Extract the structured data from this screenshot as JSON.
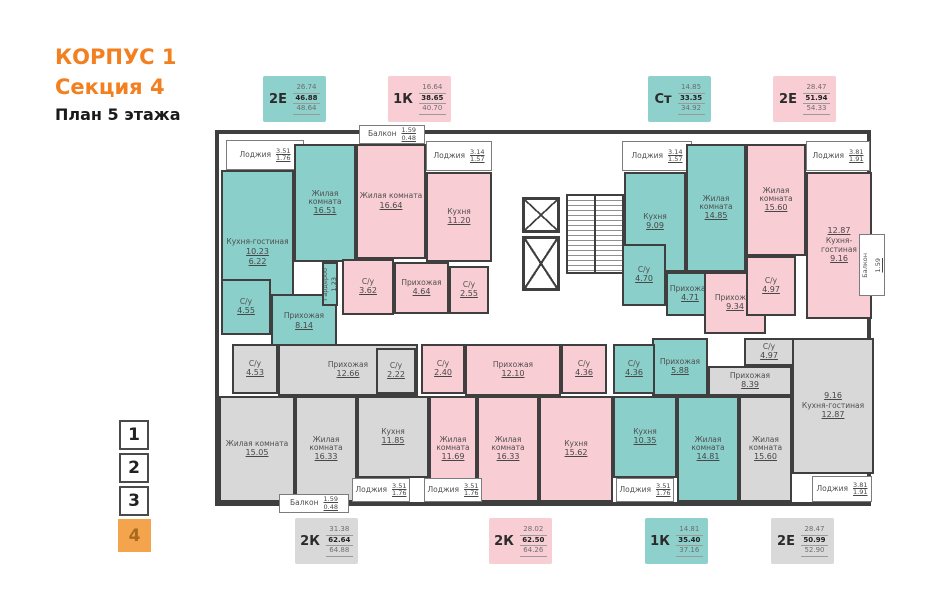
{
  "title": {
    "building": "КОРПУС 1",
    "section": "Секция 4",
    "plan": "План 5 этажа"
  },
  "colors": {
    "teal": "#8ed0cb",
    "pink": "#f9cdd4",
    "gray": "#d9d9d9",
    "wall": "#3f3f3f",
    "accent": "#f28021",
    "floor_active": "#f3a44c"
  },
  "legend_top": [
    {
      "type": "2Е",
      "color": "teal",
      "values": [
        "26.74",
        "46.88",
        "48.64"
      ]
    },
    {
      "type": "1К",
      "color": "pink",
      "values": [
        "16.64",
        "38.65",
        "40.70"
      ]
    },
    {
      "type": "Ст",
      "color": "teal",
      "values": [
        "14.85",
        "33.35",
        "34.92"
      ]
    },
    {
      "type": "2Е",
      "color": "pink",
      "values": [
        "28.47",
        "51.94",
        "54.33"
      ]
    }
  ],
  "legend_bottom": [
    {
      "type": "2К",
      "color": "gray",
      "values": [
        "31.38",
        "62.64",
        "64.88"
      ]
    },
    {
      "type": "2К",
      "color": "pink",
      "values": [
        "28.02",
        "62.50",
        "64.26"
      ]
    },
    {
      "type": "1К",
      "color": "teal",
      "values": [
        "14.81",
        "35.40",
        "37.16"
      ]
    },
    {
      "type": "2Е",
      "color": "gray",
      "values": [
        "28.47",
        "50.99",
        "52.90"
      ]
    }
  ],
  "floors": {
    "items": [
      "1",
      "2",
      "3",
      "4"
    ],
    "active": "4"
  },
  "rooms": [
    {
      "name": "Лоджия",
      "a": "3.51",
      "b": "1.76"
    },
    {
      "name": "Кухня-гостиная",
      "a": "10.23",
      "b": "6.22"
    },
    {
      "name": "Жилая комната",
      "a": "16.51"
    },
    {
      "name": "Гардероб",
      "a": "1.23"
    },
    {
      "name": "С/у",
      "a": "4.55"
    },
    {
      "name": "Прихожая",
      "a": "8.14"
    },
    {
      "name": "Балкон",
      "a": "1.59",
      "b": "0.48"
    },
    {
      "name": "Жилая комната",
      "a": "16.64"
    },
    {
      "name": "Лоджия",
      "a": "3.14",
      "b": "1.57"
    },
    {
      "name": "Кухня",
      "a": "11.20"
    },
    {
      "name": "С/у",
      "a": "3.62"
    },
    {
      "name": "Прихожая",
      "a": "4.64"
    },
    {
      "name": "С/у",
      "a": "2.55"
    },
    {
      "name": "Лоджия",
      "a": "3.14",
      "b": "1.57"
    },
    {
      "name": "Кухня",
      "a": "9.09"
    },
    {
      "name": "Жилая комната",
      "a": "14.85"
    },
    {
      "name": "С/у",
      "a": "4.70"
    },
    {
      "name": "Прихожая",
      "a": "4.71"
    },
    {
      "name": "Жилая комната",
      "a": "15.60"
    },
    {
      "name": "Лоджия",
      "a": "3.81",
      "b": "1.91"
    },
    {
      "name": "Кухня-гостиная",
      "a": "12.87",
      "b": "9.16"
    },
    {
      "name": "Прихожая",
      "a": "9.34"
    },
    {
      "name": "С/у",
      "a": "4.97"
    },
    {
      "name": "Балкон",
      "a": "1.59",
      "b": "0.48"
    },
    {
      "name": "С/у",
      "a": "4.53"
    },
    {
      "name": "Прихожая",
      "a": "12.66"
    },
    {
      "name": "С/у",
      "a": "2.22"
    },
    {
      "name": "Жилая комната",
      "a": "15.05"
    },
    {
      "name": "Жилая комната",
      "a": "16.33"
    },
    {
      "name": "Кухня",
      "a": "11.85"
    },
    {
      "name": "Лоджия",
      "a": "3.51",
      "b": "1.76"
    },
    {
      "name": "Балкон",
      "a": "1.59",
      "b": "0.48"
    },
    {
      "name": "С/у",
      "a": "2.40"
    },
    {
      "name": "Прихожая",
      "a": "12.10"
    },
    {
      "name": "Жилая комната",
      "a": "11.69"
    },
    {
      "name": "Жилая комната",
      "a": "16.33"
    },
    {
      "name": "Кухня",
      "a": "15.62"
    },
    {
      "name": "С/у",
      "a": "4.36"
    },
    {
      "name": "Лоджия",
      "a": "3.51",
      "b": "1.76"
    },
    {
      "name": "С/у",
      "a": "4.36"
    },
    {
      "name": "Прихожая",
      "a": "5.88"
    },
    {
      "name": "Кухня",
      "a": "10.35"
    },
    {
      "name": "Жилая комната",
      "a": "14.81"
    },
    {
      "name": "Лоджия",
      "a": "3.51",
      "b": "1.76"
    },
    {
      "name": "С/у",
      "a": "4.97"
    },
    {
      "name": "Прихожая",
      "a": "8.39"
    },
    {
      "name": "Кухня-гостиная",
      "a": "9.16",
      "b": "12.87"
    },
    {
      "name": "Жилая комната",
      "a": "15.60"
    },
    {
      "name": "Лоджия",
      "a": "3.81",
      "b": "1.91"
    }
  ]
}
